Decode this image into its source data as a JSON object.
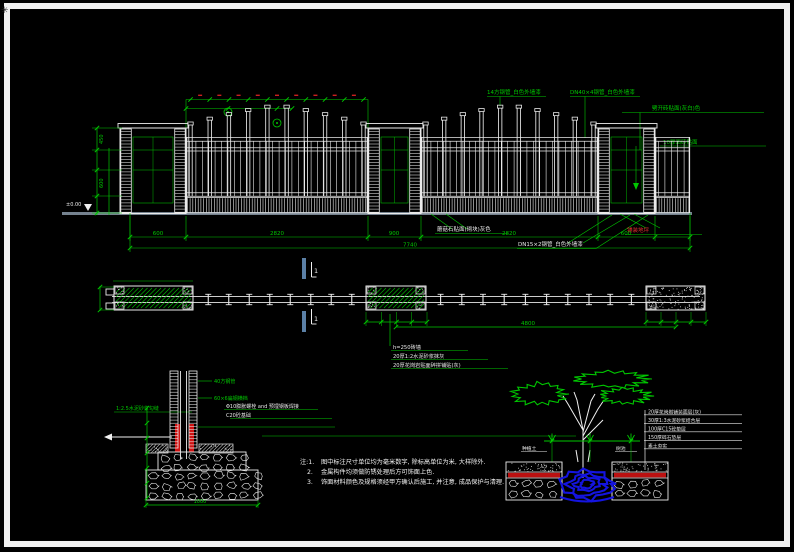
{
  "meta": {
    "frame_glyph": "✳",
    "colors": {
      "background": "#000000",
      "frame": "#f0f0f0",
      "cad_green": "#00c800",
      "cad_white": "#eaeaea",
      "cad_red": "#cc1111",
      "section_blue": "#5b80a6",
      "rootball_blue": "#1414e0",
      "ground_gray": "#75828f"
    }
  },
  "elevation": {
    "annotations_top": [
      "14方钢管_白色外墙漆",
      "DN40×4钢管_白色外墙漆",
      "劈开砖贴面(灰白)色",
      "10厚面砖贴面"
    ],
    "annotations_bottom": [
      "蘑菇石贴面(砌块)灰色",
      "DN15×2钢管_白色外墙漆",
      "铺装地坪"
    ],
    "level_mark": "±0.00",
    "dims_bottom": [
      "600",
      "2820",
      "900",
      "2820",
      "600"
    ],
    "dim_total": "7740",
    "dims_left": [
      "450",
      "600"
    ]
  },
  "plan": {
    "section_label": "1",
    "dim_long": "4800",
    "callouts": [
      "h=250砖墙",
      "20厚1:2水泥砂浆抹灰",
      "20厚花岗岩贴面碎拼铺贴(灰)"
    ]
  },
  "footing_detail": {
    "label_plaster": "1:2.5水泥砂浆勾缝",
    "label_steel_1": "40方钢管",
    "label_steel_2": "60×6扁钢横档",
    "callout_bolt": "Φ10膨胀螺栓 and 预埋钢板焊接",
    "callout_concrete": "C20砼基础",
    "dim_bottom": "1000"
  },
  "tree_detail": {
    "label_left": "种植土",
    "label_right": "树池",
    "layers": [
      "20厚花岗岩铺装面层(灰)",
      "30厚1:3水泥砂浆结合层",
      "100厚C15砼垫层",
      "150厚碎石垫层",
      "素土夯实"
    ]
  },
  "notes": {
    "n1": "注:1.",
    "line1": "图中标注尺寸单位均为毫米数字, 除标高单位为米, 大样除外.",
    "n2": "2.",
    "line2": "金属构件均须做防锈处理后方可饰面上色.",
    "n3": "3.",
    "line3": "饰面材料颜色及规格须经甲方确认后施工, 并注意, 成品保护与清理."
  }
}
